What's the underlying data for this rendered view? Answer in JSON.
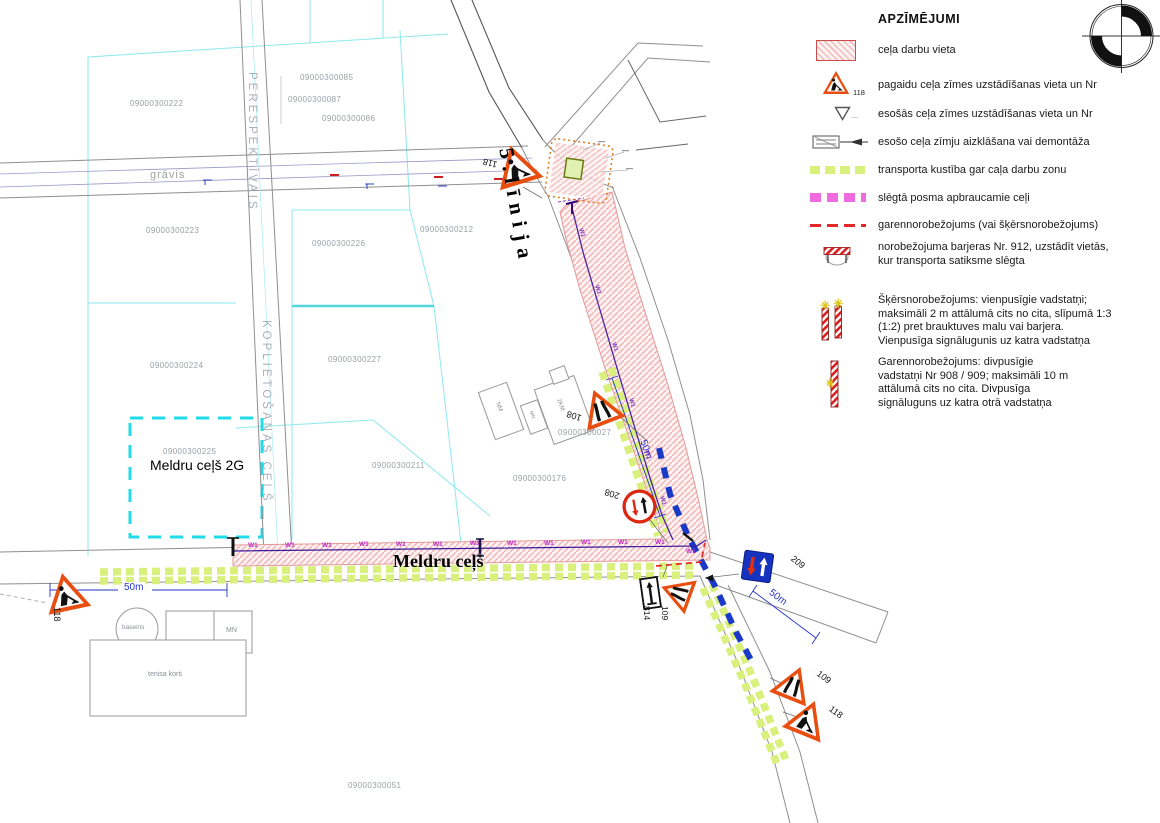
{
  "legend": {
    "title": "APZĪMĒJUMI",
    "items": [
      {
        "key": "work-zone",
        "text": "ceļa darbu vieta"
      },
      {
        "key": "temp-sign",
        "text": "pagaidu ceļa zīmes uzstādīšanas vieta un Nr",
        "nr": "118"
      },
      {
        "key": "existing-sign",
        "text": "esošās ceļa zīmes uzstādīšanas vieta un Nr"
      },
      {
        "key": "sign-cover",
        "text": "esošo ceļa zīmju aizklāšana vai demontāža"
      },
      {
        "key": "traffic-along",
        "text": "transporta kustība gar caļa darbu zonu"
      },
      {
        "key": "detour",
        "text": "slēgtā posma apbraucamie ceļi"
      },
      {
        "key": "longitudinal",
        "text": "garennorobežojums (vai šķērsnorobežojums)"
      },
      {
        "key": "barrier",
        "text": "norobežojuma barjeras Nr. 912, uzstādīt vietās,\nkur transporta satiksme slēgta"
      },
      {
        "key": "cross-posts",
        "text": "Šķērsnorobežojums: vienpusīgie vadstatņi;\nmaksimāli 2 m attālumā cits no cita, slīpumā 1:3\n(1:2) pret brauktuves malu vai barjera.\nVienpusīga signālugunis uz katra vadstatņa"
      },
      {
        "key": "long-posts",
        "text": "Garennorobežojums: divpusīgie\nvadstatņi Nr 908 / 909; maksimāli 10 m\nattālumā cits no cita. Divpusīga\nsignāluguns uz katra otrā vadstatņa"
      }
    ]
  },
  "roads": {
    "perspektivais": "PERESPEKTĪVAIS",
    "koplietosanas": "KOPLIETOŠANAS CEĻŠ",
    "linija5": "5.līnija",
    "meldru": "Meldru ceļš",
    "gravis": "grāvis"
  },
  "area": {
    "parcel": "09000300225",
    "name": "Meldru ceļš 2G"
  },
  "parcels": [
    "09000300222",
    "09000300085",
    "09000300087",
    "09000300086",
    "09000300223",
    "09000300226",
    "09000300212",
    "09000300224",
    "09000300227",
    "09000300211",
    "09000300176",
    "09000300027",
    "09000300051"
  ],
  "signs": {
    "s118": "118",
    "s108": "108",
    "s208": "208",
    "s209": "209",
    "s814": "814",
    "s109": "109"
  },
  "labels": {
    "w1": "W1",
    "dim50": "50m"
  },
  "buildings": {
    "pool": "baseins",
    "mn": "MN",
    "tennis": "tenisa korti",
    "nm": "NM",
    "mn2": "MN",
    "km2": "2KM"
  },
  "colors": {
    "work_zone_border": "#cc4b4b",
    "work_zone_fill": "#f2bcbc",
    "traffic_green": "#d9f07c",
    "detour_magenta": "#f06ae0",
    "limit_red": "#e22828",
    "detour_blue": "#1b39c8",
    "utility_purple": "#3a1b9e",
    "w1_magenta": "#bc2cc4",
    "parcel_cyan": "#8de9ee",
    "highlight_cyan": "#22dbe8",
    "dim_blue": "#2633c8",
    "sign_orange": "#e84e0f",
    "sign_blue": "#1633c0"
  }
}
